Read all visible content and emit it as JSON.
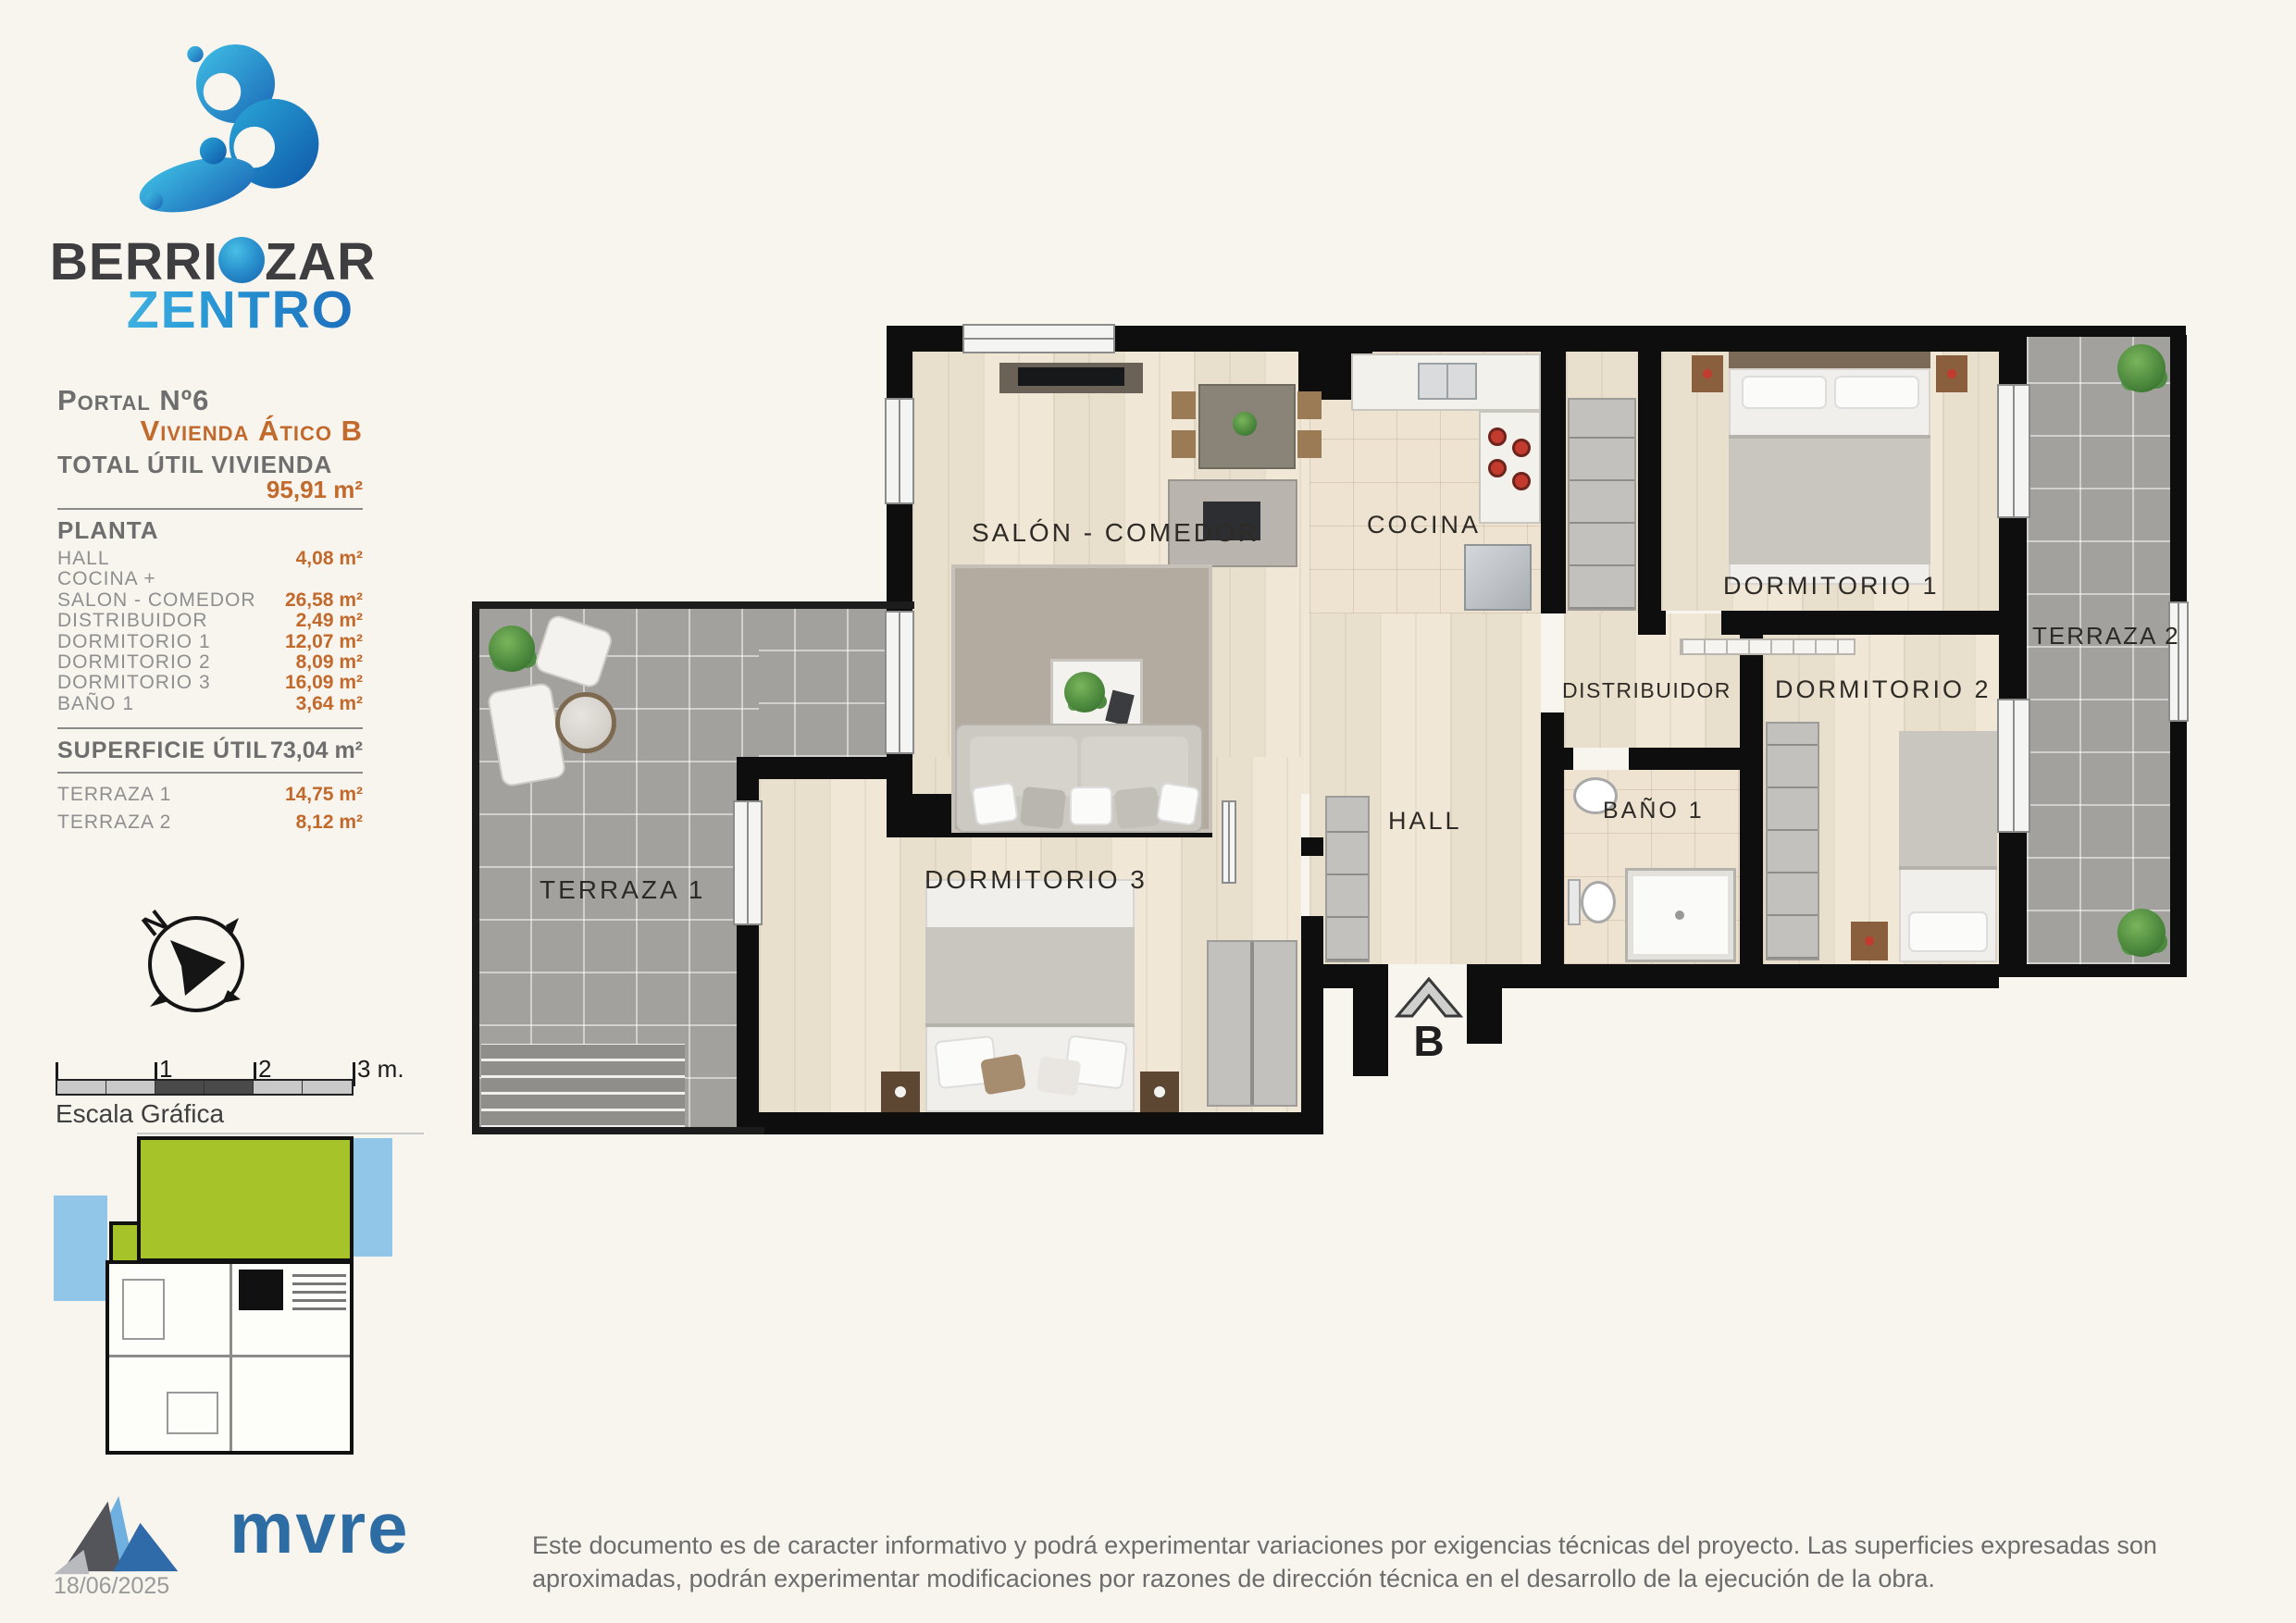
{
  "brand": {
    "l1a": "BERRI",
    "l1b": "O",
    "l1c": "ZAR",
    "line2": "ZENTRO"
  },
  "info": {
    "portal": "Portal Nº6",
    "vivienda": "Vivienda Ático B",
    "total_label": "TOTAL ÚTIL VIVIENDA",
    "total_value": "95,91 m²",
    "planta_label": "PLANTA",
    "rooms": [
      {
        "label": "HALL",
        "value": "4,08 m²"
      },
      {
        "label": "COCINA +",
        "value": ""
      },
      {
        "label": "SALON - COMEDOR",
        "value": "26,58 m²"
      },
      {
        "label": "DISTRIBUIDOR",
        "value": "2,49 m²"
      },
      {
        "label": "DORMITORIO 1",
        "value": "12,07 m²"
      },
      {
        "label": "DORMITORIO 2",
        "value": "8,09 m²"
      },
      {
        "label": "DORMITORIO 3",
        "value": "16,09 m²"
      },
      {
        "label": "BAÑO 1",
        "value": "3,64 m²"
      }
    ],
    "superficie_label": "SUPERFICIE ÚTIL",
    "superficie_value": "73,04 m²",
    "terrazas": [
      {
        "label": "TERRAZA 1",
        "value": "14,75 m²"
      },
      {
        "label": "TERRAZA 2",
        "value": "8,12 m²"
      }
    ]
  },
  "compass": {
    "north": "N"
  },
  "scale_bar": {
    "ticks": [
      "1",
      "2",
      "3 m."
    ],
    "caption": "Escala Gráfica"
  },
  "plan": {
    "labels": {
      "salon": "SALÓN - COMEDOR",
      "cocina": "COCINA",
      "dormitorio1": "DORMITORIO 1",
      "terraza2": "TERRAZA 2",
      "distribuidor": "DISTRIBUIDOR",
      "dormitorio2": "DORMITORIO 2",
      "hall": "HALL",
      "bano1": "BAÑO 1",
      "dormitorio3": "DORMITORIO 3",
      "terraza1": "TERRAZA 1",
      "entrance": "B"
    }
  },
  "footer": {
    "brand": "mvre",
    "date": "18/06/2025",
    "disclaimer": "Este documento es de caracter informativo y podrá experimentar variaciones por exigencias técnicas del proyecto. Las superficies expresadas son aproximadas, podrán experimentar modificaciones por razones de dirección técnica en el desarrollo de la ejecución de la obra."
  },
  "colors": {
    "accent_orange": "#c2692c",
    "logo_blue_light": "#3fc0e6",
    "logo_blue_dark": "#1b66b5",
    "highlight_green": "#a6c32a",
    "terrace_blue": "#92c6e9",
    "mvre_blue": "#2e6da4"
  }
}
